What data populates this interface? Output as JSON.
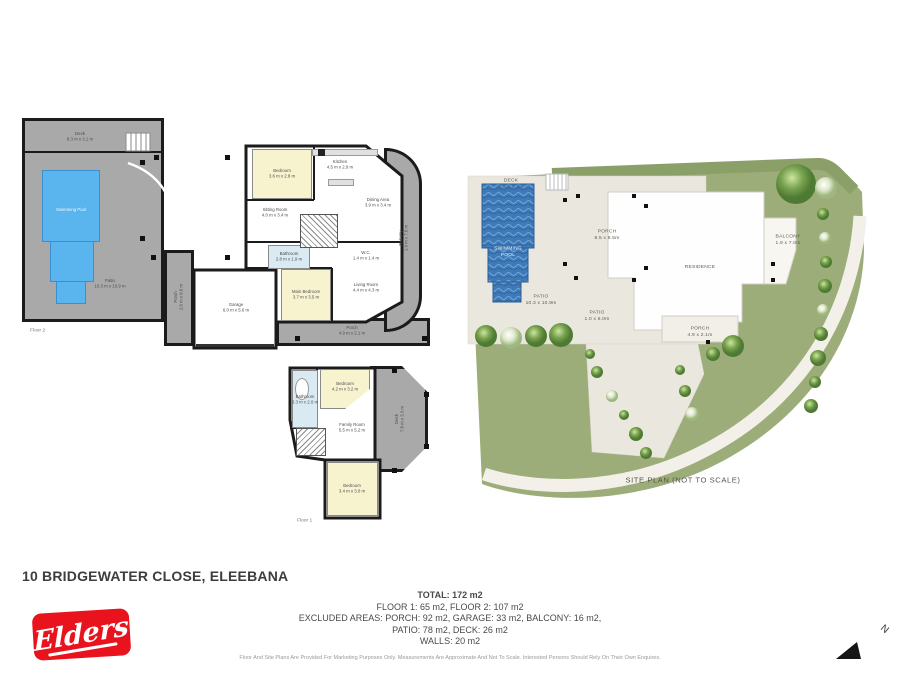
{
  "page": {
    "address": "10 BRIDGEWATER CLOSE, ELEEBANA",
    "brand": "Elders",
    "north_label": "N",
    "disclaimer": "Floor And Site Plans Are Provided For Marketing Purposes Only. Measurements Are Approximate And Not To Scale. Interested Persons Should Rely On Their Own Enquires."
  },
  "summary": {
    "total": "TOTAL: 172 m2",
    "floors": "FLOOR 1: 65 m2, FLOOR 2: 107 m2",
    "excluded_1": "EXCLUDED AREAS: PORCH: 92 m2, GARAGE: 33 m2, BALCONY: 16 m2,",
    "excluded_2": "PATIO: 78 m2, DECK: 26 m2",
    "walls": "WALLS: 20 m2"
  },
  "floor2": {
    "label": "Floor 2",
    "rooms": {
      "deck": {
        "name": "Deck",
        "dims": "8.3 m x 3.1 m"
      },
      "pool": {
        "name": "Swimming Pool",
        "dims": ""
      },
      "patio": {
        "name": "Patio",
        "dims": "10.3 m x 10.9 m"
      },
      "bedroom": {
        "name": "Bedroom",
        "dims": "3.6 m x 2.8 m"
      },
      "kitchen": {
        "name": "Kitchen",
        "dims": "4.5 m x 2.9 m"
      },
      "dining": {
        "name": "Dining Area",
        "dims": "3.9 m x 3.4 m"
      },
      "sitting": {
        "name": "Sitting Room",
        "dims": "4.0 m x 3.4 m"
      },
      "balcony": {
        "name": "Balcony",
        "dims": "1.9 m x 7.0 m"
      },
      "bathroom": {
        "name": "Bathroom",
        "dims": "2.8 m x 1.9 m"
      },
      "wc": {
        "name": "W.C.",
        "dims": "1.4 m x 1.4 m"
      },
      "main_bedroom": {
        "name": "Main Bedroom",
        "dims": "3.7 m x 3.5 m"
      },
      "living": {
        "name": "Living Room",
        "dims": "4.4 m x 4.3 m"
      },
      "garage": {
        "name": "Garage",
        "dims": "6.0 m x 5.6 m"
      },
      "porch": {
        "name": "Porch",
        "dims": "4.9 m x 2.1 m"
      },
      "porch_side": {
        "name": "Porch",
        "dims": "2.0 m x 8.0 m"
      }
    }
  },
  "floor1": {
    "label": "Floor 1",
    "rooms": {
      "bathroom": {
        "name": "Bathroom",
        "dims": "3.3 m x 2.0 m"
      },
      "bedroom_top": {
        "name": "Bedroom",
        "dims": "4.2 m x 3.2 m"
      },
      "family": {
        "name": "Family Room",
        "dims": "5.5 m x 5.2 m"
      },
      "deck": {
        "name": "Deck",
        "dims": "7.8 m x 3.3 m"
      },
      "bedroom_bottom": {
        "name": "Bedroom",
        "dims": "3.4 m x 3.0 m"
      }
    }
  },
  "site_plan": {
    "caption": "SITE PLAN (NOT TO SCALE)",
    "labels": {
      "deck": {
        "name": "DECK",
        "dims": "8.3 x 3.1m"
      },
      "pool": {
        "name": "SWIMMING POOL",
        "dims": ""
      },
      "porch_main": {
        "name": "PORCH",
        "dims": "8.5 x 8.5m"
      },
      "patio_main": {
        "name": "PATIO",
        "dims": "10.3 x 10.9m"
      },
      "patio_small": {
        "name": "PATIO",
        "dims": "1.0 x 6.0m"
      },
      "residence": {
        "name": "RESIDENCE",
        "dims": ""
      },
      "balcony": {
        "name": "BALCONY",
        "dims": "1.9 x 7.0m"
      },
      "porch_front": {
        "name": "PORCH",
        "dims": "4.9 x 2.1m"
      }
    }
  },
  "colors": {
    "brand_red": "#e8131c",
    "patio_gray": "#a9a9a9",
    "pool_blue": "#5ab5ef",
    "room_yellow": "#f7f3cf",
    "bath_blue": "#d9eaf3",
    "lawn_green": "#9cad7a",
    "pavement_beige": "#eae7de",
    "wall_black": "#1b1b1b"
  }
}
